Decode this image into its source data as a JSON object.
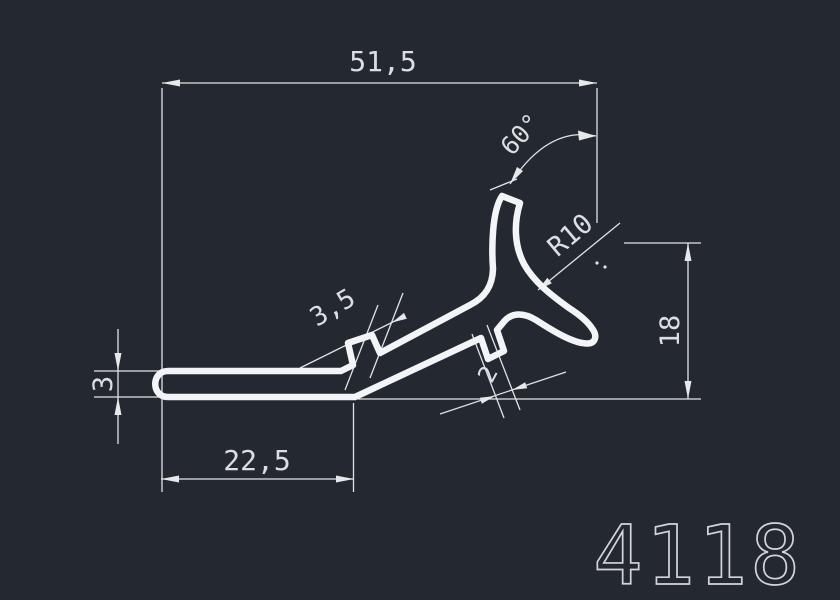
{
  "drawing": {
    "part_number": "4118",
    "dimensions": {
      "overall_width": "51,5",
      "base_length": "22,5",
      "base_thickness": "3",
      "height": "18",
      "tab_width": "3,5",
      "notch_width": "2",
      "radius": "R10",
      "angle": "60°"
    },
    "colors": {
      "background": "#242931",
      "geometry_line": "#f2f4f6",
      "dimension_line": "#e0e3e6",
      "dimension_text": "#dcdfe2"
    }
  }
}
